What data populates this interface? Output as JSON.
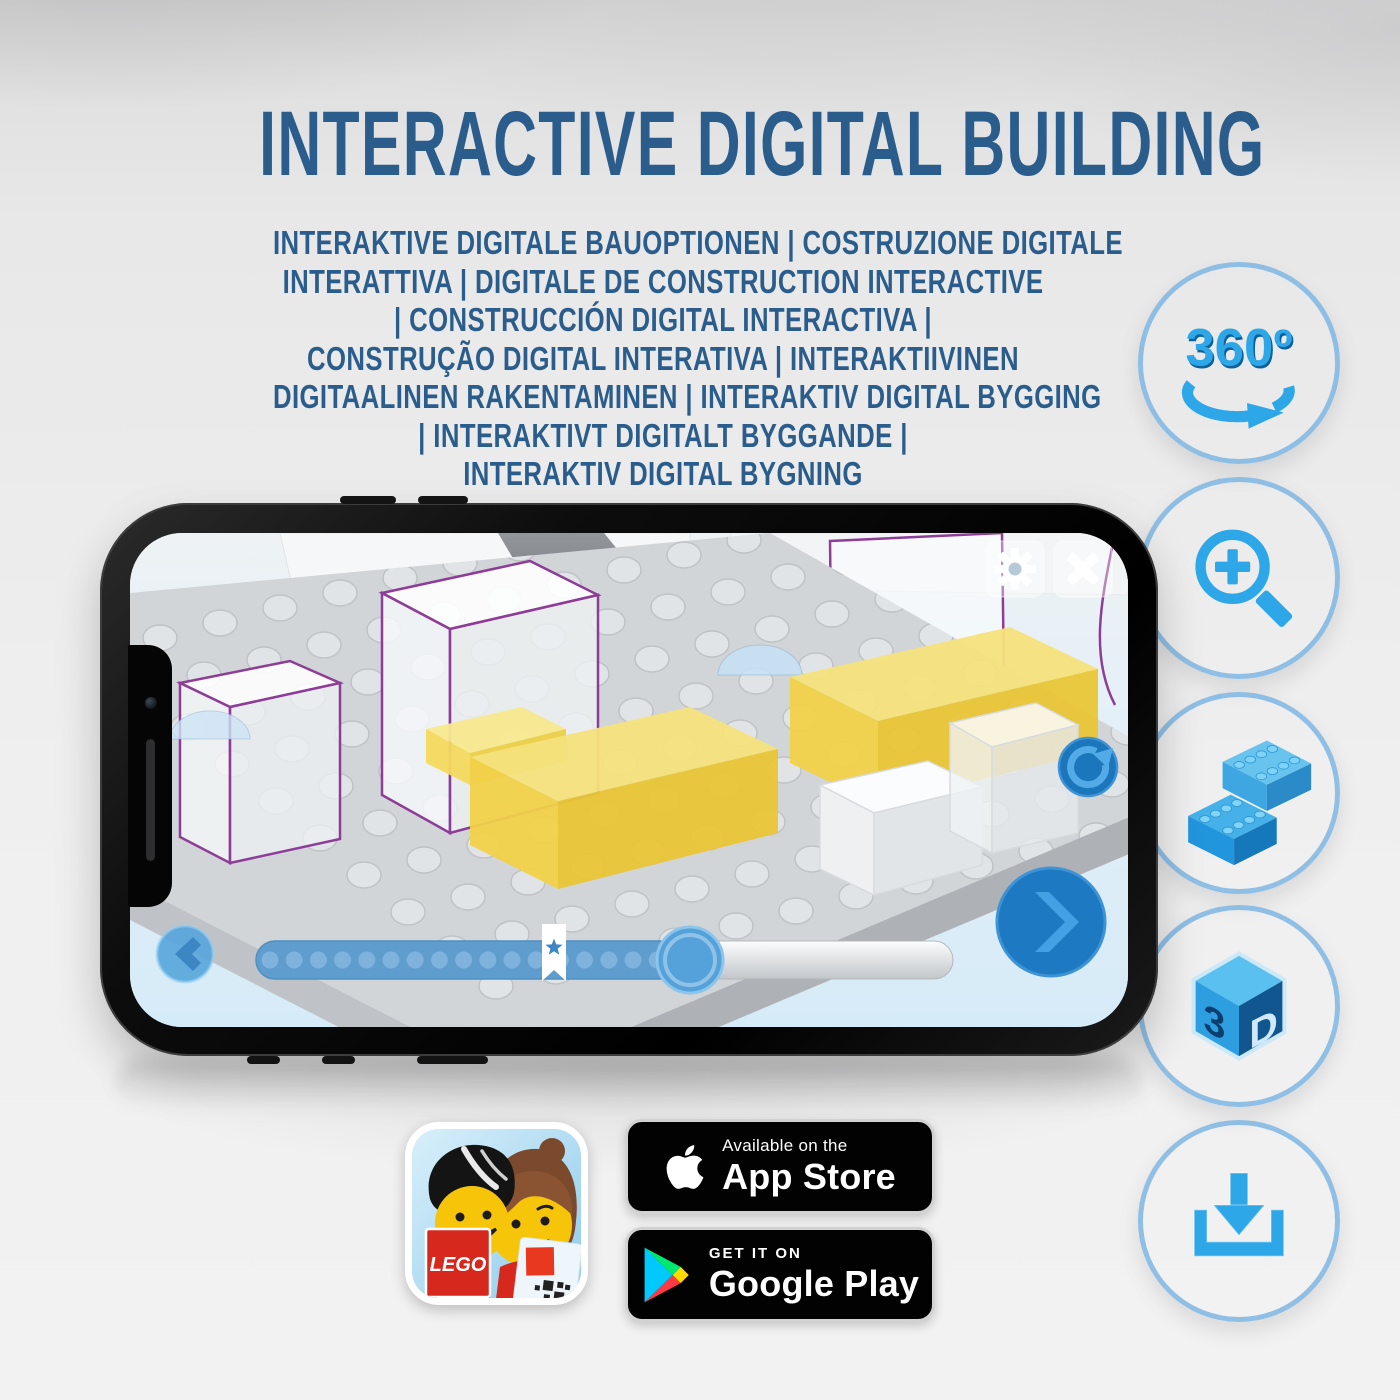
{
  "header": {
    "title": "INTERACTIVE DIGITAL BUILDING",
    "subtitle_lines": [
      "INTERAKTIVE DIGITALE BAUOPTIONEN | COSTRUZIONE DIGITALE",
      "INTERATTIVA | DIGITALE DE CONSTRUCTION INTERACTIVE",
      "| CONSTRUCCIÓN DIGITAL INTERACTIVA |",
      "CONSTRUÇÃO DIGITAL INTERATIVA | INTERAKTIIVINEN",
      "DIGITAALINEN RAKENTAMINEN | INTERAKTIV DIGITAL BYGGING",
      "| INTERAKTIVT DIGITALT BYGGANDE |",
      "INTERAKTIV DIGITAL BYGNING"
    ]
  },
  "feature_icons": {
    "items": [
      "360-rotation-icon",
      "zoom-in-icon",
      "lego-brick-icon",
      "3d-cube-icon",
      "download-icon"
    ],
    "rotate_label": "360º",
    "cube_left": "3",
    "cube_right": "D"
  },
  "phone_app": {
    "top_buttons": [
      "settings-gear",
      "close"
    ],
    "side_buttons": [
      "rotate-view"
    ],
    "nav_buttons": [
      "previous-step",
      "next-step"
    ],
    "slider": {
      "fill_percent": 62,
      "bookmark_percent": 43,
      "dot_count": 18
    }
  },
  "store": {
    "lego_app_label": "LEGO",
    "app_store": {
      "tagline": "Available on the",
      "name": "App Store"
    },
    "google_play": {
      "tagline": "GET IT ON",
      "name": "Google Play"
    }
  },
  "colors": {
    "title_text": "#2a5d8c",
    "icon_circle_fill": "#0e6eb5",
    "icon_circle_rim": "#89bce4",
    "icon_glyph": "#2da7e8",
    "screen_sky": "#d8ecf9",
    "bed_yellow": "#f1d149",
    "ghost_outline": "#8d3d97",
    "slider_fill": "#5f9dce"
  }
}
